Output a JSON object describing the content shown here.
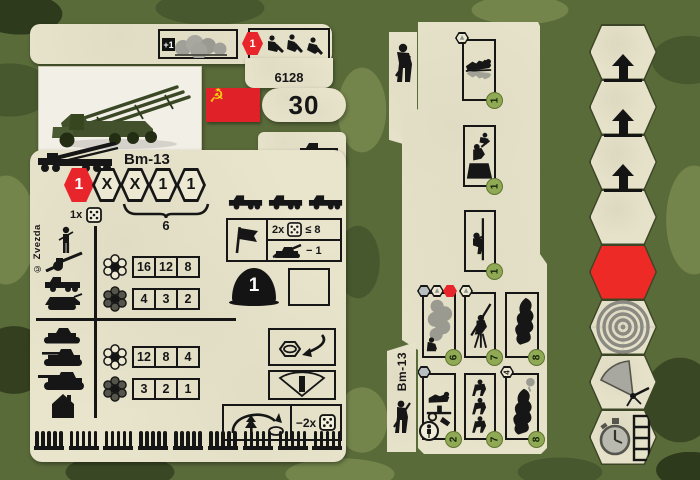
{
  "colors": {
    "camo_base": "#5a6b3a",
    "camo_light": "#74854b",
    "camo_dark": "#48582e",
    "card": "#e9e5cd",
    "red": "#e8252b",
    "badge_green": "#8fa955",
    "gold": "#f6cf12",
    "black": "#161616"
  },
  "left_card": {
    "header": {
      "concealment_bonus": "+1",
      "entrench_count": "1",
      "product_code": "6128"
    },
    "flag_star": "★",
    "flag_emblem": "☭",
    "points": "30",
    "unit_name": "Bm-13",
    "copyright": "© Zvezda",
    "stat_hexes": [
      "1",
      "X",
      "X",
      "1",
      "1"
    ],
    "salvo_label": "1x",
    "range": "6",
    "attack_table": {
      "groups": [
        {
          "rows": [
            {
              "values": [
                "16",
                "12",
                "8"
              ]
            },
            {
              "values": [
                "4",
                "3",
                "2"
              ]
            }
          ]
        },
        {
          "rows": [
            {
              "values": [
                "12",
                "8",
                "4"
              ]
            },
            {
              "values": [
                "3",
                "2",
                "1"
              ]
            }
          ]
        }
      ]
    },
    "rally_box": {
      "dice": "2x",
      "check": "≤ 8",
      "penalty": "− 1"
    },
    "defense": "1",
    "indirect_fire": {
      "dice_penalty": "−2x"
    },
    "ammo_track": {
      "groups": 9,
      "per_group": 5
    }
  },
  "right_card": {
    "unit_name": "Bm-13",
    "boxes": {
      "top": [
        {
          "badge": "1"
        },
        {
          "badge": "1"
        },
        {
          "badge": "1"
        }
      ],
      "row1": [
        {
          "badge": "6"
        },
        {
          "badge": "7"
        },
        {
          "badge": "8"
        }
      ],
      "row2": [
        {
          "badge": "2"
        },
        {
          "badge": "7"
        },
        {
          "badge": "8"
        }
      ]
    },
    "hex4_label": "4",
    "mountain_glyph": "▲"
  }
}
